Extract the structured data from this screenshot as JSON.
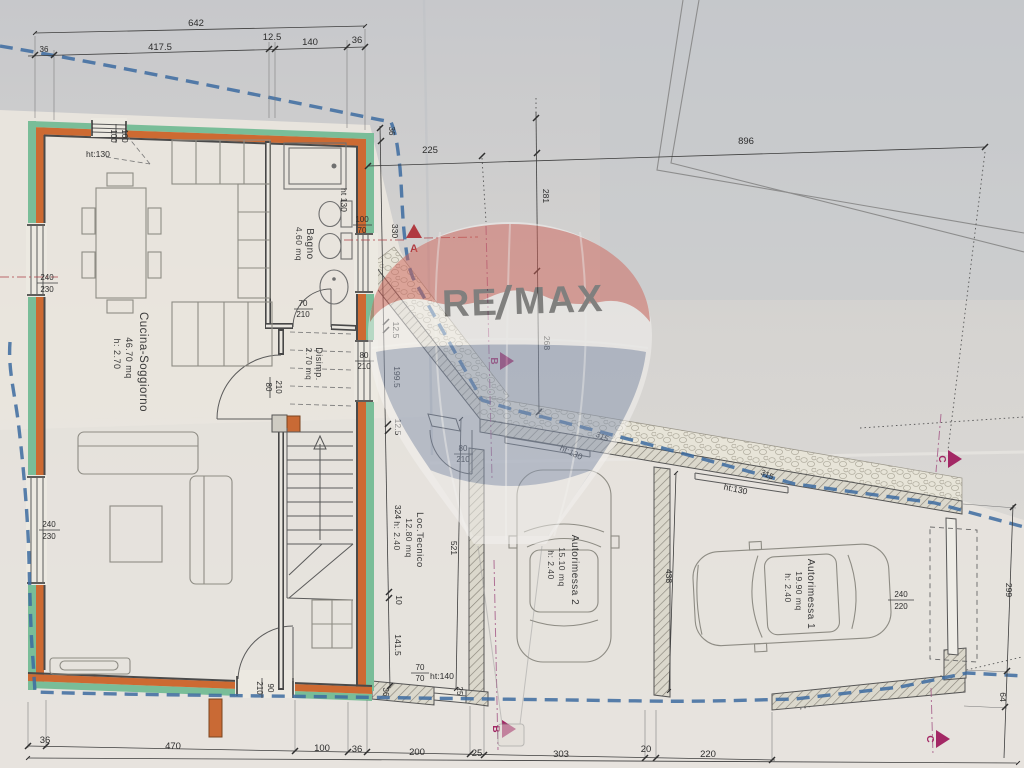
{
  "watermark": {
    "re": "RE",
    "slash": "/",
    "max": "MAX"
  },
  "rooms": {
    "cucina": {
      "name": "Cucina-Soggiorno",
      "area": "46.70 mq",
      "height": "h: 2.70"
    },
    "bagno": {
      "name": "Bagno",
      "area": "4.60 mq"
    },
    "disimpegno": {
      "name": "Disimp.",
      "area": "2.70 mq"
    },
    "loc_tecnico": {
      "name": "Loc.Tecnico",
      "area": "12.80 mq",
      "height": "h: 2.40"
    },
    "autorimessa2": {
      "name": "Autorimessa 2",
      "area": "15.10 mq",
      "height": "h: 2.40"
    },
    "autorimessa1": {
      "name": "Autorimessa 1",
      "area": "19.90 mq",
      "height": "h: 2.40"
    }
  },
  "markers": {
    "a": "A",
    "b": "B",
    "c": "C"
  },
  "dims": {
    "t642": "642",
    "t36l": "36",
    "t4175": "417.5",
    "t125": "12.5",
    "t140": "140",
    "t36r": "36",
    "r896": "896",
    "d225": "225",
    "d281": "281",
    "d268": "268",
    "d36tr": "36",
    "d330": "330",
    "d125b": "12.5",
    "d1995": "199.5",
    "d125c": "12.5",
    "d324": "324",
    "d10": "10",
    "d1415": "141.5",
    "d36b": "36",
    "d25r": "25",
    "d521": "521",
    "d438": "438",
    "d299": "299",
    "d64": "64",
    "b36a": "36",
    "b470": "470",
    "b100": "100",
    "b36b": "36",
    "b200": "200",
    "b25": "25",
    "b303": "303",
    "b20": "20",
    "b220": "220",
    "d315a": "315",
    "d315b": "315"
  },
  "openings": {
    "w100t": "100",
    "w100b": "100",
    "wbag_t": "100",
    "wbag_b": "70",
    "wl1t": "240",
    "wl1b": "230",
    "wl2t": "240",
    "wl2b": "230",
    "dbag_t": "70",
    "dbag_b": "210",
    "dkit_t": "80",
    "dkit_b": "210",
    "ddis_t": "80",
    "ddis_b": "210",
    "dlt_t": "80",
    "dlt_b": "210",
    "dent_t": "210",
    "dent_b": "90",
    "w7070t": "70",
    "w7070b": "70",
    "g1t": "240",
    "g1b": "220"
  },
  "heights": {
    "h130a": "ht:130",
    "h130b": "ht 130",
    "h130c": "ht:130",
    "h130d": "ht:130",
    "h140": "ht:140"
  }
}
